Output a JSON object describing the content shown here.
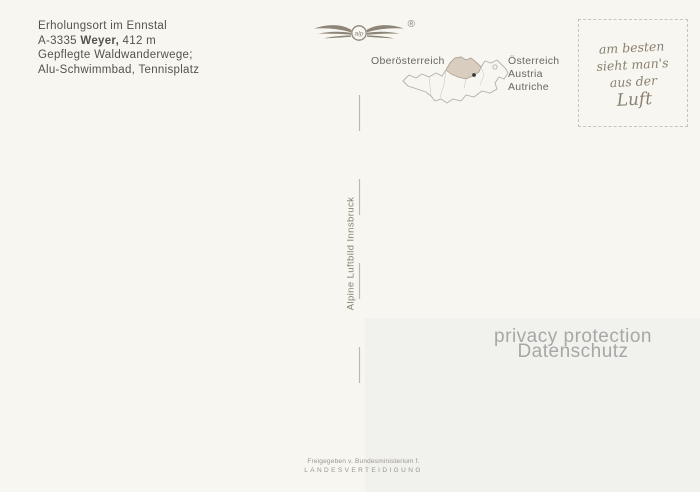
{
  "postcard": {
    "info": {
      "line1": "Erholungsort im Ennstal",
      "line2_prefix": "A-3335 ",
      "line2_bold": "Weyer,",
      "line2_suffix": " 412 m",
      "line3": "Gepflegte Waldwanderwege;",
      "line4": "Alu-Schwimmbad, Tennisplatz"
    },
    "logo": {
      "monogram": "alp",
      "registered": "®"
    },
    "map": {
      "label_left": "Oberösterreich",
      "labels_right": [
        "Österreich",
        "Austria",
        "Autriche"
      ]
    },
    "stamp_box": {
      "lines": [
        "am besten",
        "sieht man's",
        "aus der",
        "Luft"
      ]
    },
    "publisher_vertical": "Alpine Luftbild Innsbruck",
    "privacy": {
      "line1": "privacy protection",
      "line2": "Datenschutz"
    },
    "imprint": {
      "line1": "Freigegeben v. Bundesministerium f.",
      "line2": "LANDESVERTEIDIGUNG"
    },
    "colors": {
      "card_background": "#f8f6f1",
      "ink_dark": "#56524a",
      "ink_gray": "#85816f",
      "map_outline": "#b5afa3",
      "oberoesterreich_fill": "#d9cdc0",
      "privacy_text": "#a7a7a5",
      "stamp_border": "#c9c5ba"
    }
  }
}
